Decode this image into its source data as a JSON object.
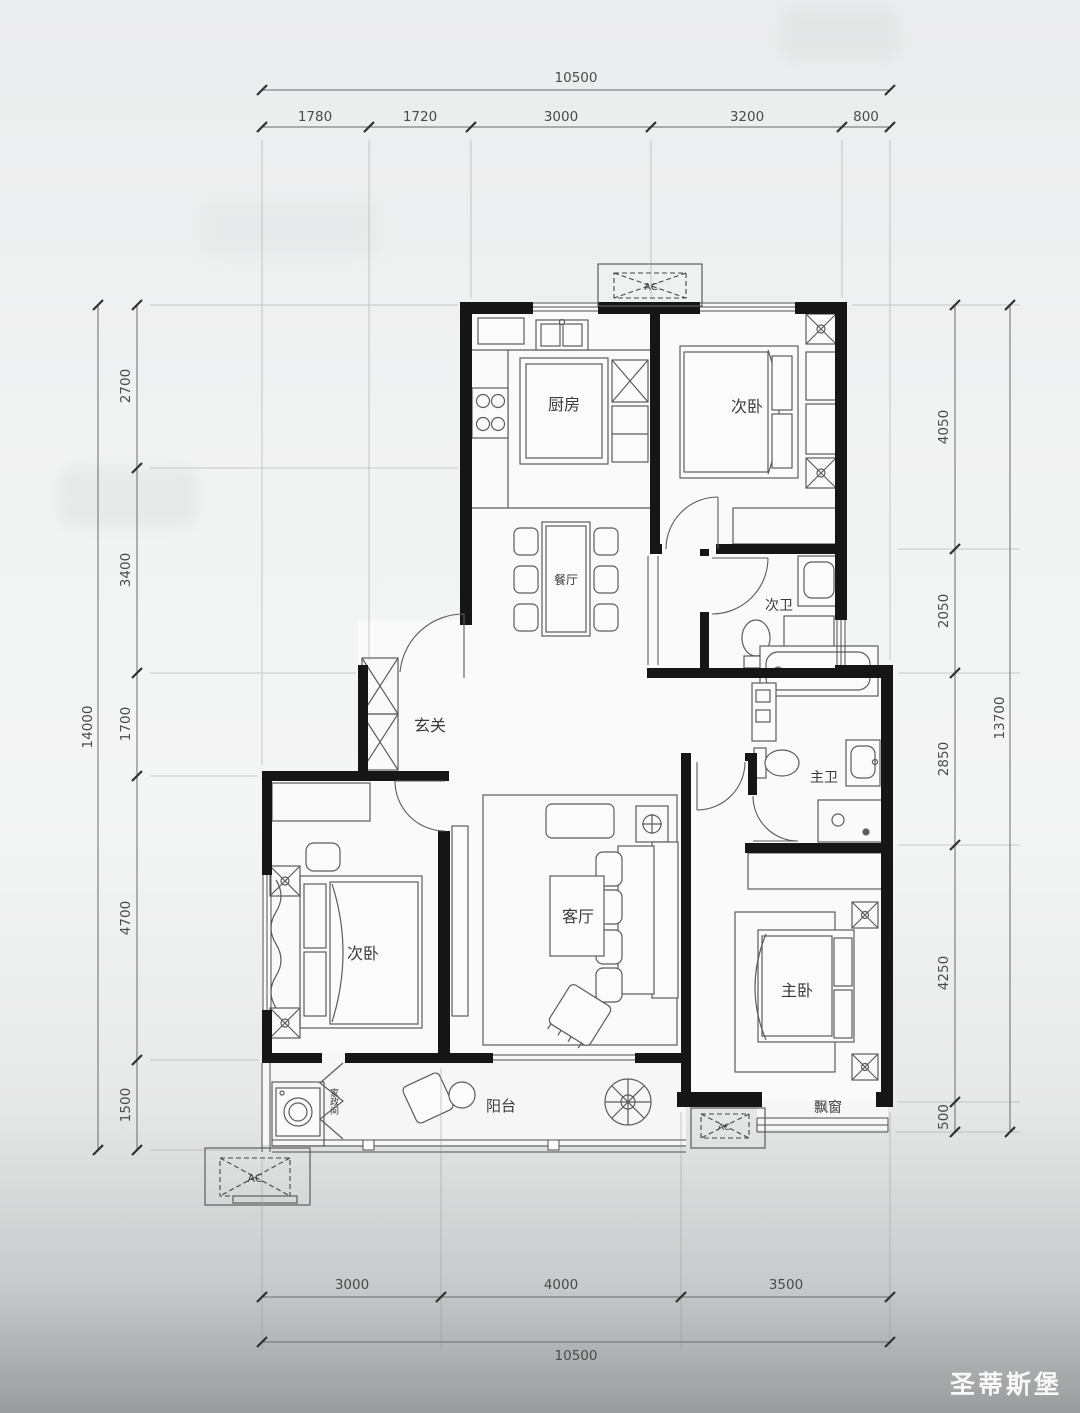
{
  "watermark": {
    "brand": "圣蒂斯堡"
  },
  "plan": {
    "ac_label": "AC",
    "rooms": {
      "kitchen": {
        "label": "厨房"
      },
      "bedroom_top": {
        "label": "次卧"
      },
      "dining": {
        "label": "餐厅"
      },
      "bath_second": {
        "label": "次卫"
      },
      "foyer": {
        "label": "玄关"
      },
      "living": {
        "label": "客厅"
      },
      "bedroom_left": {
        "label": "次卧"
      },
      "bath_master": {
        "label": "主卫"
      },
      "bedroom_master": {
        "label": "主卧"
      },
      "balcony": {
        "label": "阳台"
      },
      "bay_window": {
        "label": "飘窗"
      },
      "laundry": {
        "label": "家政间"
      }
    },
    "dimensions": {
      "top": {
        "total": "10500",
        "segments": [
          "1780",
          "1720",
          "3000",
          "3200",
          "800"
        ]
      },
      "bottom": {
        "total": "10500",
        "segments": [
          "3000",
          "4000",
          "3500"
        ]
      },
      "left": {
        "total": "14000",
        "segments": [
          "2700",
          "3400",
          "1700",
          "4700",
          "1500"
        ]
      },
      "right": {
        "total": "13700",
        "segments": [
          "4050",
          "2050",
          "2850",
          "4250",
          "500"
        ]
      }
    }
  }
}
